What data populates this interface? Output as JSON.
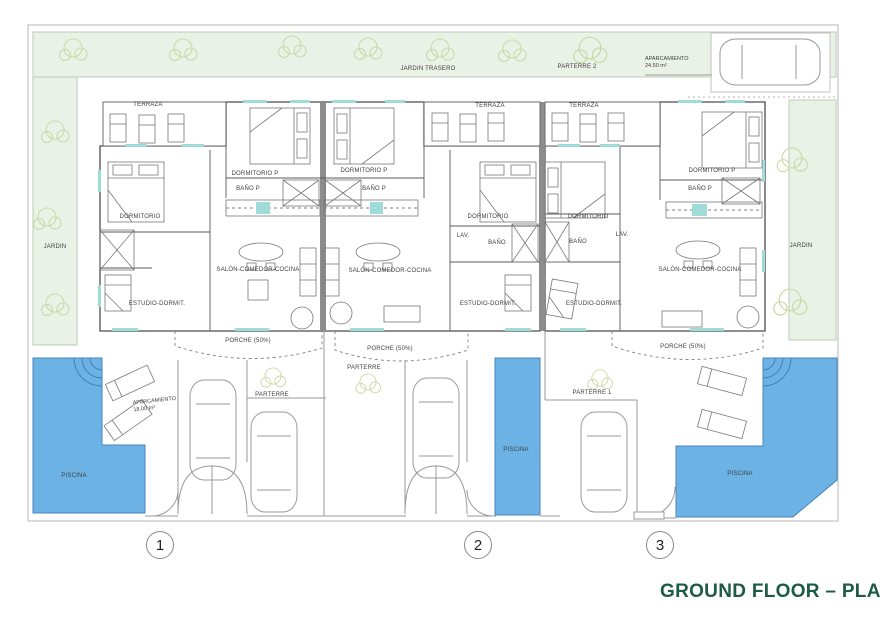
{
  "title": {
    "text": "GROUND FLOOR – PLANTA B"
  },
  "plan": {
    "site_labels": {
      "jardin_trasero": "JARDIN TRASERO",
      "jardin_left": "JARDIN",
      "jardin_right": "JARDIN",
      "parterre_2": "PARTERRE 2",
      "aparcamiento_top_l1": "APARCAMIENTO",
      "aparcamiento_top_l2": "24.50 m²",
      "aparcamiento_1_l1": "APARCAMIENTO",
      "aparcamiento_1_l2": "18.00 m²",
      "parterre_a": "PARTERRE",
      "parterre_b": "PARTERRE",
      "parterre_1": "PARTERRE 1",
      "piscina_1": "PISCINA",
      "piscina_2": "PISCINA",
      "piscina_3": "PISCINA"
    },
    "units": [
      {
        "number": "1",
        "labels": {
          "terraza": "TERRAZA",
          "dormitorio_p": "DORMITORIO P",
          "bano_p": "BAÑO P",
          "dormitorio": "DORMITORIO",
          "salon": "SALÓN-COMEDOR-COCINA",
          "estudio": "ESTUDIO-DORMIT.",
          "porche": "PORCHE (50%)"
        }
      },
      {
        "number": "2",
        "labels": {
          "terraza": "TERRAZA",
          "dormitorio_p": "DORMITORIO P",
          "bano_p": "BAÑO P",
          "dormitorio": "DORMITORIO",
          "lav": "LAV.",
          "bano": "BAÑO",
          "salon": "SALÓN-COMEDOR-COCINA",
          "estudio": "ESTUDIO-DORMIT.",
          "porche": "PORCHE (50%)"
        }
      },
      {
        "number": "3",
        "labels": {
          "terraza": "TERRAZA",
          "dormitorio_p": "DORMITORIO P",
          "bano_p": "BAÑO P",
          "dormitorio": "DORMITORIO",
          "bano": "BAÑO",
          "lav": "LAV.",
          "salon": "SALÓN-COMEDOR-COCINA",
          "estudio": "ESTUDIO-DORMIT.",
          "porche": "PORCHE (50%)"
        }
      }
    ],
    "colors": {
      "unit1_fill": "#f7f4d5",
      "unit2_fill": "#f9e9dc",
      "unit3_fill": "#ead2d6",
      "pool_blue": "#6cb2e4",
      "garden_green": "#eaf1e6",
      "window_teal": "#9fdcd8",
      "title_green": "#1d5b46"
    }
  }
}
